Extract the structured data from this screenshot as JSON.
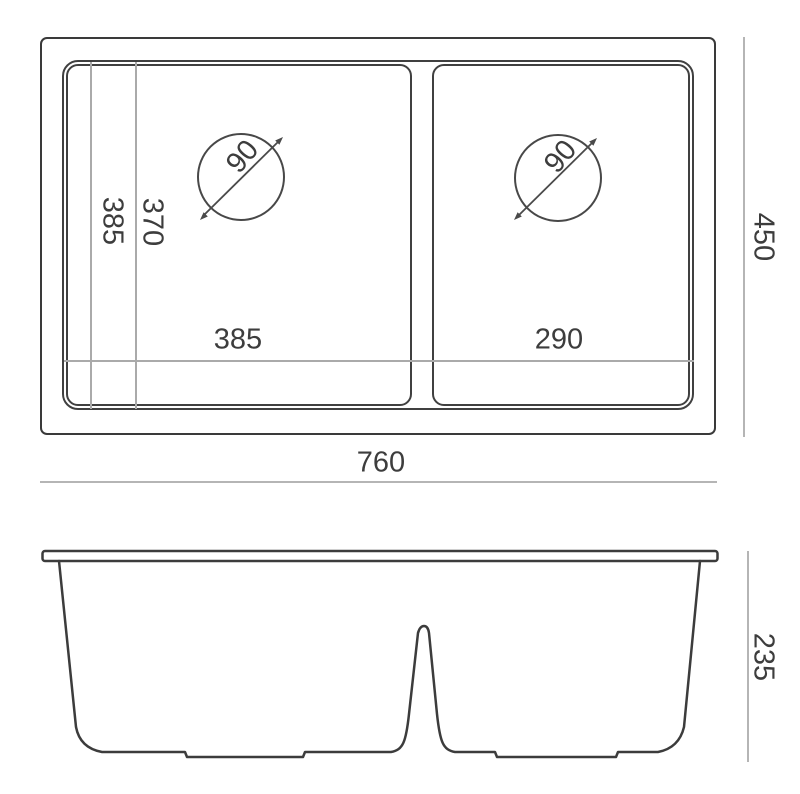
{
  "drawing": {
    "title": "double-bowl-sink-technical-drawing",
    "colors": {
      "background": "#ffffff",
      "main_line": "#3c3c3c",
      "dimension_line": "#b5b5b5",
      "text": "#3d3d3d"
    }
  },
  "top_view": {
    "overall_width_label": "760",
    "overall_depth_label": "450",
    "left_bowl_width_label": "385",
    "right_bowl_width_label": "290",
    "bowl_length_label": "385",
    "bowl_inner_length_label": "370",
    "left_drain_diameter_label": "90",
    "right_drain_diameter_label": "90"
  },
  "front_view": {
    "height_label": "235"
  }
}
